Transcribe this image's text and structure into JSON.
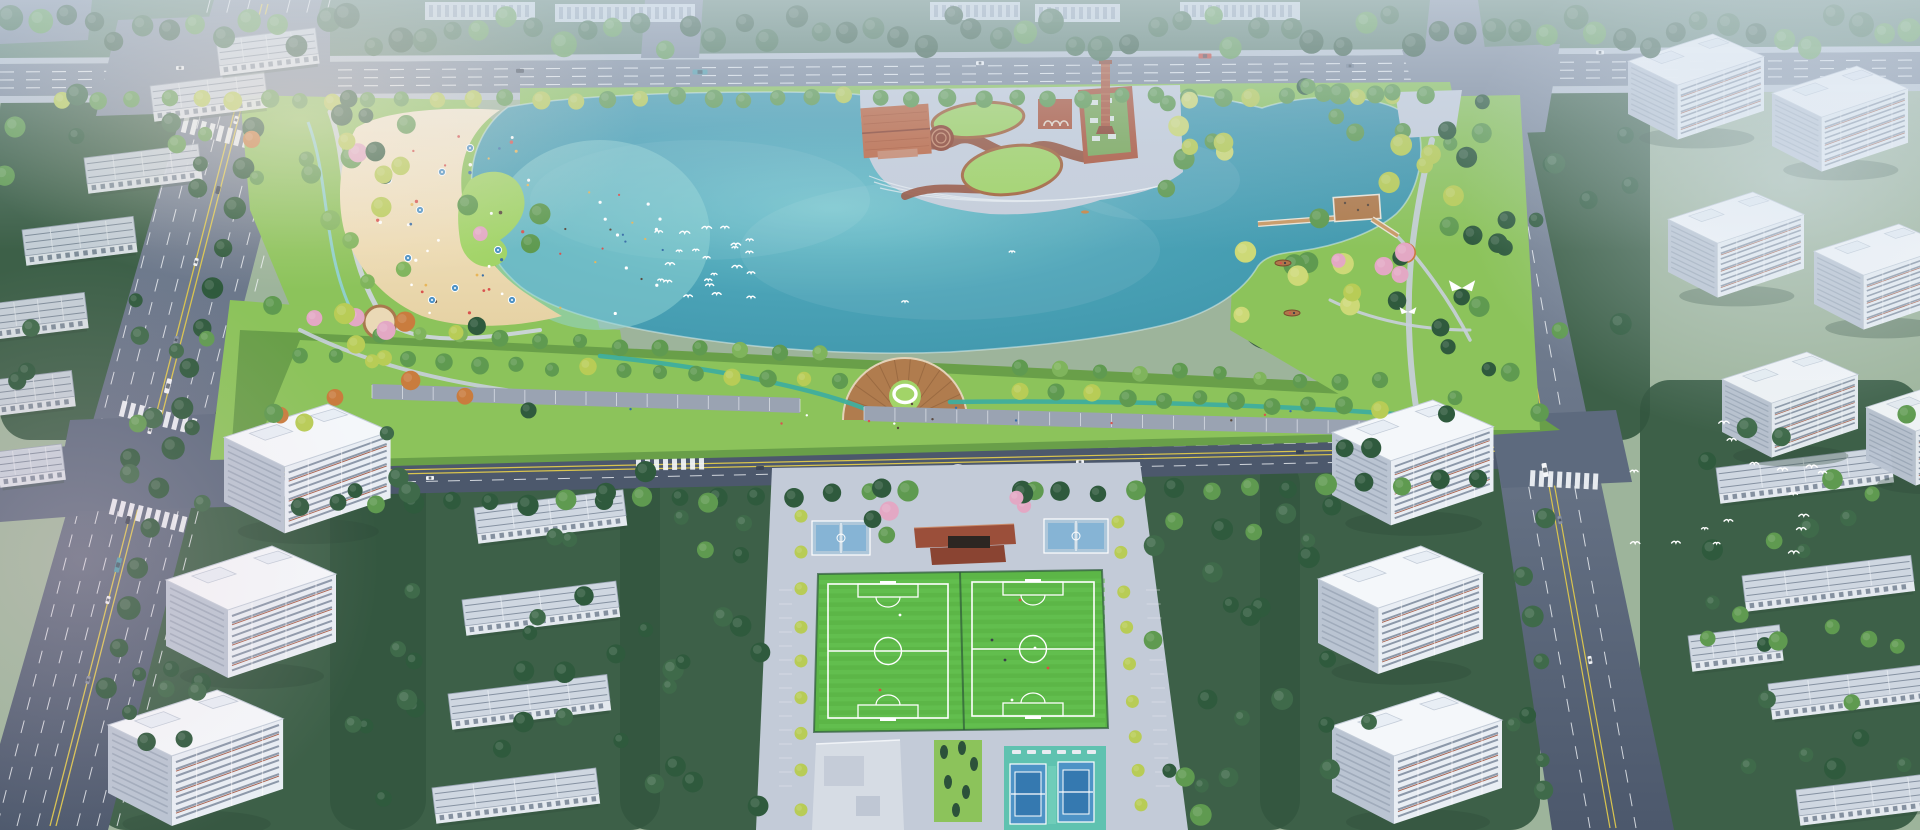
{
  "meta": {
    "title": "Aerial masterplan rendering: urban lake park with beach, heritage plaza and sports fields",
    "type": "architectural bird's-eye rendering",
    "visible_text": "none"
  },
  "palette": {
    "base": "#9db49b",
    "forest_dark": "#33573f",
    "forest_mid": "#3f6a4a",
    "tree_dark": "#2f5a3d",
    "tree_green": "#5f9a50",
    "tree_light": "#7fb45c",
    "tree_yellow": "#b8cc56",
    "tree_willow": "#cdd977",
    "tree_orange": "#c97c3e",
    "tree_pink": "#e3a8c4",
    "conifer": "#2c523a",
    "lawn": "#8cc35b",
    "lawn_bright": "#a2d468",
    "lawn_dark": "#699f49",
    "road": "#4c586c",
    "road_far": "#7e8a9c",
    "road_mid": "#5d6a7e",
    "lane_white": "#f2f5f8",
    "lane_yellow": "#d9c44e",
    "sidewalk": "#b7c1ce",
    "plaza": "#c6cedb",
    "plaza_light": "#d4dae6",
    "sand": "#f4e6c2",
    "sand_shadow": "#e6d2a4",
    "lake": "#4aa2b6",
    "lake_deep": "#3d93a9",
    "lake_light": "#6fc3cc",
    "lake_shallow": "#93d6d6",
    "track": "#3fae9e",
    "wood": "#b07c4e",
    "deck_light": "#c99a66",
    "brick": "#ad573d",
    "brick_dark": "#8d4430",
    "terracotta": "#bd6743",
    "path_red": "#95503a",
    "green_roof": "#7aa858",
    "tower_face": "#e9eef4",
    "tower_side": "#bac4d2",
    "tower_roof": "#f4f7fa",
    "tower_window": "#7c8a9c",
    "tower_accent": "#a04f38",
    "slab_roof": "#cfd7e1",
    "slab_face": "#e4e9ef",
    "slab_line": "#6d7a8c",
    "court_base": "#aec7da",
    "court_blue": "#4e93c6",
    "court_blue_dark": "#3579b0",
    "court_teal": "#5fc2b0",
    "building_gray": "#d6dce4",
    "white": "#ffffff",
    "car_red": "#c6473c",
    "bus_teal": "#4e9aa8"
  },
  "scene": {
    "lake": {
      "label": "central lake with northeast lobe",
      "boats": 2,
      "kayaks": 1,
      "swans": 9
    },
    "beach": {
      "label": "artificial sand beach on west shore",
      "umbrellas": 9,
      "visitors": "crowded",
      "lawn_island": 1
    },
    "heritage_plaza": {
      "label": "industrial heritage plaza on north shore",
      "chimney": 1,
      "red_roof_hall": 1,
      "brick_arch_building": 1,
      "green_roof_workshop": 1,
      "oval_lawn_mounds": 2,
      "sunken_circle": 1
    },
    "viewing_deck": {
      "label": "fan-shaped timber deck over south shore",
      "ring_sculpture": 1
    },
    "pier": {
      "label": "zigzag boardwalk pier across northeast lobe",
      "platforms": 1
    },
    "east_lawn": {
      "label": "east shore lawn",
      "white_wing_sculptures": 2
    },
    "playground": {
      "label": "round sand playground in west park",
      "count": 1
    },
    "south_entrance": {
      "label": "semicircular entrance plaza with radial lawns",
      "sculpture": 1
    },
    "sports_park": {
      "football_pitches": 2,
      "basketball_courts": 2,
      "tennis_courts": 2,
      "pavilion": 1,
      "service_building": 1,
      "conifer_garden": 1,
      "players": 8
    },
    "roads": {
      "top_arterial": 1,
      "west_arterial": 1,
      "east_arterial": 1,
      "south_collector": 1,
      "intersections": 4,
      "street_parking_rows": 2
    },
    "residential": {
      "northwest_slabs": 7,
      "north_slabs_behind_trees": 5,
      "west_towers": 3,
      "west_midrise_slabs": 4,
      "northeast_towers": 6,
      "southeast_towers": 3,
      "east_midrise_slabs": 5
    },
    "bird_flocks": [
      {
        "area": "over lake",
        "count": 22
      },
      {
        "area": "over southeast junction",
        "count": 16
      }
    ],
    "jogging_track": {
      "label": "teal jogging track along south promenade"
    }
  }
}
